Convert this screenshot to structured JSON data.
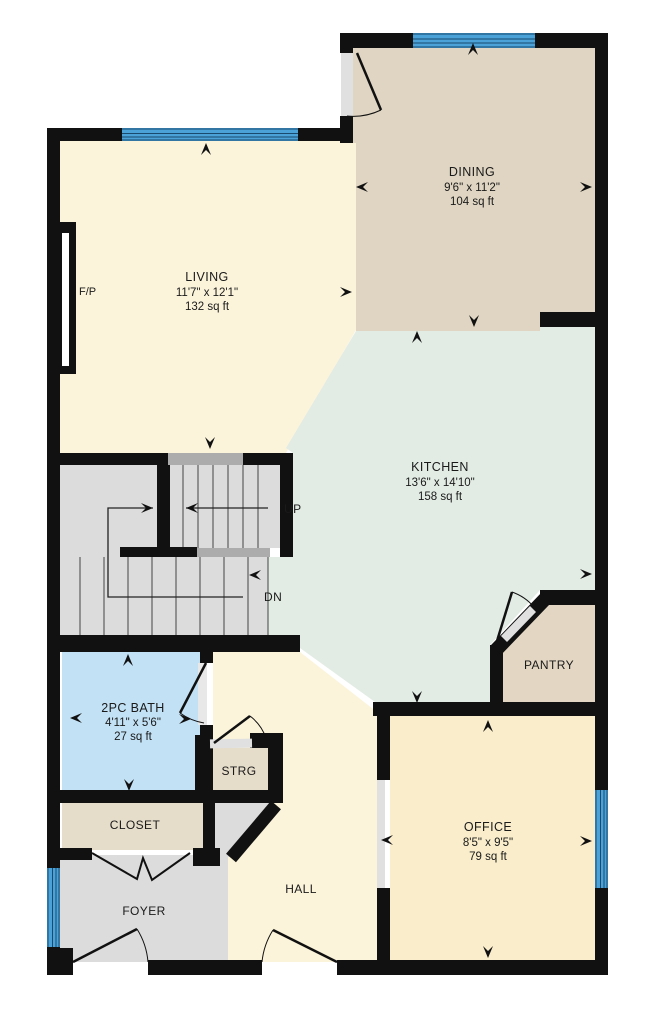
{
  "colors": {
    "wall": "#111111",
    "living": "#FBF4DB",
    "dining": "#DFD5C2",
    "kitchen": "#E2ECE4",
    "bath": "#C2E1F5",
    "office": "#F9EDCB",
    "hall": "#FBF4DB",
    "pantry": "#E3D7C4",
    "closet": "#E6DCCA",
    "strg": "#E6DCCA",
    "foyer": "#DCDCDC",
    "stairs": "#DCDCDC",
    "landing": "#ACACAC",
    "window": "#4BA2D9",
    "window_line": "#1A4A6E",
    "threshold": "#E0E0E0",
    "text": "#1A1A1A"
  },
  "rooms": [
    {
      "id": "living",
      "name": "LIVING",
      "dims": "11'7\" x 12'1\"",
      "area": "132 sq ft"
    },
    {
      "id": "dining",
      "name": "DINING",
      "dims": "9'6\" x 11'2\"",
      "area": "104 sq ft"
    },
    {
      "id": "kitchen",
      "name": "KITCHEN",
      "dims": "13'6\" x 14'10\"",
      "area": "158 sq ft"
    },
    {
      "id": "bath",
      "name": "2PC BATH",
      "dims": "4'11\" x 5'6\"",
      "area": "27 sq ft"
    },
    {
      "id": "office",
      "name": "OFFICE",
      "dims": "8'5\" x 9'5\"",
      "area": "79 sq ft"
    },
    {
      "id": "pantry",
      "name": "PANTRY"
    },
    {
      "id": "strg",
      "name": "STRG"
    },
    {
      "id": "closet",
      "name": "CLOSET"
    },
    {
      "id": "foyer",
      "name": "FOYER"
    },
    {
      "id": "hall",
      "name": "HALL"
    }
  ],
  "labels": {
    "fireplace": "F/P",
    "up": "UP",
    "down": "DN"
  }
}
